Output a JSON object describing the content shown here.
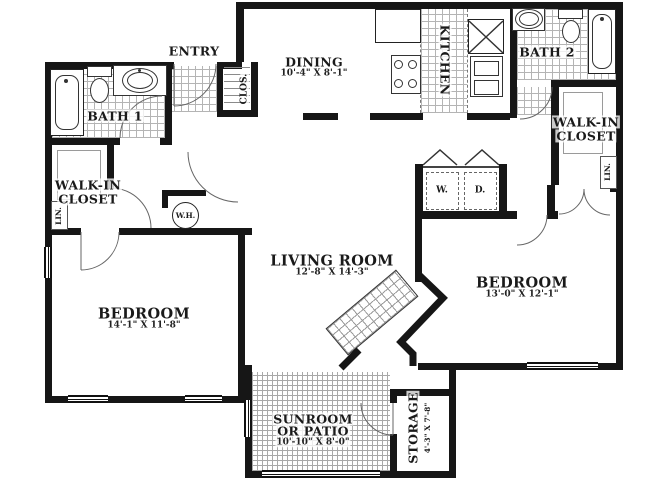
{
  "labels": {
    "entry": "ENTRY",
    "dining": "DINING",
    "dining_dims": "10'-4\" X 8'-1\"",
    "kitchen": "KITCHEN",
    "bath1": "BATH 1",
    "bath2": "BATH 2",
    "clos": "CLOS.",
    "walkin_line1": "WALK-IN",
    "walkin_line2": "CLOSET",
    "lin": "LIN.",
    "water_heater": "W.H.",
    "washer": "W.",
    "dryer": "D.",
    "living": "LIVING ROOM",
    "living_dims": "12'-8\" X 14'-3\"",
    "bedroom_left": "BEDROOM",
    "bedroom_left_dims": "14'-1\" X 11'-8\"",
    "bedroom_right": "BEDROOM",
    "bedroom_right_dims": "13'-0\" X 12'-1\"",
    "sunroom_line1": "SUNROOM",
    "sunroom_line2": "OR PATIO",
    "sunroom_dims": "10'-10\" X 8'-0\"",
    "storage": "STORAGE",
    "storage_dims": "4'-3\" X 7'-8\""
  },
  "colors": {
    "wall": "#161616",
    "tile_line": "#b4b4b4",
    "door_arc": "#666666",
    "background": "#ffffff"
  }
}
